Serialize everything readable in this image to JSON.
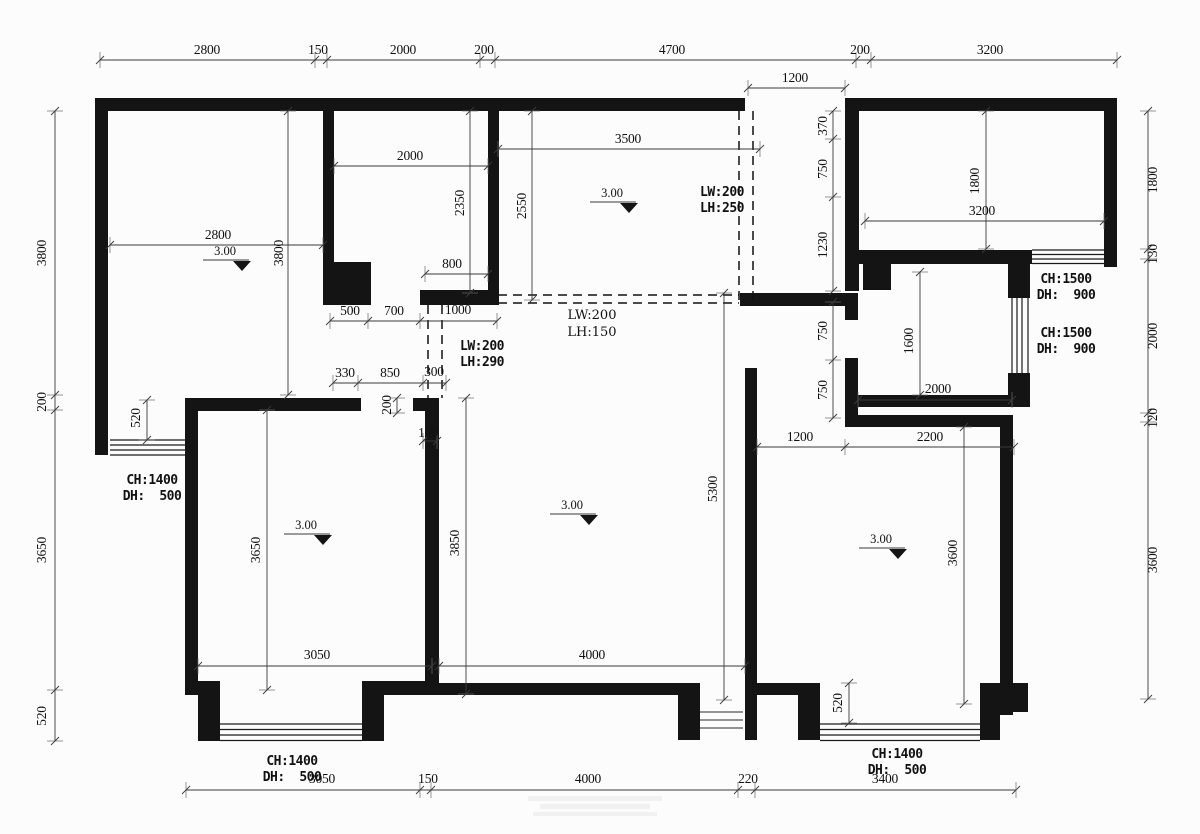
{
  "style": {
    "background": "#fcfcfc",
    "wall_color": "#141414",
    "dim_color": "#3a3a3a"
  },
  "labels": [
    {
      "text": "2800",
      "x": 207,
      "y": 54
    },
    {
      "text": "150",
      "x": 318,
      "y": 54
    },
    {
      "text": "2000",
      "x": 403,
      "y": 54
    },
    {
      "text": "200",
      "x": 484,
      "y": 54
    },
    {
      "text": "4700",
      "x": 672,
      "y": 54
    },
    {
      "text": "200",
      "x": 860,
      "y": 54
    },
    {
      "text": "3200",
      "x": 990,
      "y": 54
    },
    {
      "text": "1200",
      "x": 795,
      "y": 82
    },
    {
      "text": "3800",
      "x": 46,
      "y": 253,
      "rot": 1
    },
    {
      "text": "200",
      "x": 46,
      "y": 402,
      "rot": 1
    },
    {
      "text": "3650",
      "x": 46,
      "y": 550,
      "rot": 1
    },
    {
      "text": "520",
      "x": 46,
      "y": 716,
      "rot": 1
    },
    {
      "text": "1800",
      "x": 1157,
      "y": 180,
      "rot": 1
    },
    {
      "text": "130",
      "x": 1157,
      "y": 254,
      "rot": 1
    },
    {
      "text": "2000",
      "x": 1157,
      "y": 336,
      "rot": 1
    },
    {
      "text": "120",
      "x": 1157,
      "y": 418,
      "rot": 1
    },
    {
      "text": "3600",
      "x": 1157,
      "y": 560,
      "rot": 1
    },
    {
      "text": "3050",
      "x": 322,
      "y": 783
    },
    {
      "text": "150",
      "x": 428,
      "y": 783
    },
    {
      "text": "4000",
      "x": 588,
      "y": 783
    },
    {
      "text": "220",
      "x": 748,
      "y": 783
    },
    {
      "text": "3400",
      "x": 885,
      "y": 783
    },
    {
      "text": "2800",
      "x": 218,
      "y": 239
    },
    {
      "text": "3800",
      "x": 283,
      "y": 253,
      "rot": 1
    },
    {
      "text": "520",
      "x": 140,
      "y": 418,
      "rot": 1
    },
    {
      "text": "2000",
      "x": 410,
      "y": 160
    },
    {
      "text": "2350",
      "x": 464,
      "y": 203,
      "rot": 1
    },
    {
      "text": "800",
      "x": 452,
      "y": 268
    },
    {
      "text": "500",
      "x": 350,
      "y": 315
    },
    {
      "text": "700",
      "x": 394,
      "y": 315
    },
    {
      "text": "1000",
      "x": 458,
      "y": 314
    },
    {
      "text": "330",
      "x": 345,
      "y": 377
    },
    {
      "text": "850",
      "x": 390,
      "y": 377
    },
    {
      "text": "300",
      "x": 434,
      "y": 376
    },
    {
      "text": "200",
      "x": 391,
      "y": 405,
      "rot": 1
    },
    {
      "text": "100",
      "x": 428,
      "y": 437
    },
    {
      "text": "3500",
      "x": 628,
      "y": 143
    },
    {
      "text": "2550",
      "x": 526,
      "y": 206,
      "rot": 1
    },
    {
      "text": "370",
      "x": 827,
      "y": 126,
      "rot": 1
    },
    {
      "text": "750",
      "x": 827,
      "y": 169,
      "rot": 1
    },
    {
      "text": "1230",
      "x": 827,
      "y": 245,
      "rot": 1
    },
    {
      "text": "750",
      "x": 827,
      "y": 331,
      "rot": 1
    },
    {
      "text": "750",
      "x": 827,
      "y": 390,
      "rot": 1
    },
    {
      "text": "1800",
      "x": 979,
      "y": 181,
      "rot": 1
    },
    {
      "text": "3200",
      "x": 982,
      "y": 215
    },
    {
      "text": "1600",
      "x": 913,
      "y": 341,
      "rot": 1
    },
    {
      "text": "2000",
      "x": 938,
      "y": 393
    },
    {
      "text": "1200",
      "x": 800,
      "y": 441
    },
    {
      "text": "2200",
      "x": 930,
      "y": 441
    },
    {
      "text": "3850",
      "x": 459,
      "y": 543,
      "rot": 1
    },
    {
      "text": "5300",
      "x": 717,
      "y": 489,
      "rot": 1
    },
    {
      "text": "4000",
      "x": 592,
      "y": 659
    },
    {
      "text": "3650",
      "x": 260,
      "y": 550,
      "rot": 1
    },
    {
      "text": "3050",
      "x": 317,
      "y": 659
    },
    {
      "text": "3600",
      "x": 957,
      "y": 553,
      "rot": 1
    },
    {
      "text": "520",
      "x": 842,
      "y": 703,
      "rot": 1
    },
    {
      "text": "LW:200",
      "x": 722,
      "y": 196,
      "cls": "b"
    },
    {
      "text": "LH:250",
      "x": 722,
      "y": 212,
      "cls": "b"
    },
    {
      "text": "LW:200",
      "x": 592,
      "y": 319,
      "cls": "n"
    },
    {
      "text": "LH:150",
      "x": 592,
      "y": 336,
      "cls": "n"
    },
    {
      "text": "LW:200",
      "x": 482,
      "y": 350,
      "cls": "b"
    },
    {
      "text": "LH:290",
      "x": 482,
      "y": 366,
      "cls": "b"
    },
    {
      "text": "CH:1500",
      "x": 1066,
      "y": 283,
      "cls": "b"
    },
    {
      "text": "DH:  900",
      "x": 1066,
      "y": 299,
      "cls": "b"
    },
    {
      "text": "CH:1500",
      "x": 1066,
      "y": 337,
      "cls": "b"
    },
    {
      "text": "DH:  900",
      "x": 1066,
      "y": 353,
      "cls": "b"
    },
    {
      "text": "CH:1400",
      "x": 152,
      "y": 484,
      "cls": "b"
    },
    {
      "text": "DH:  500",
      "x": 152,
      "y": 500,
      "cls": "b"
    },
    {
      "text": "CH:1400",
      "x": 292,
      "y": 765,
      "cls": "b"
    },
    {
      "text": "DH:  500",
      "x": 292,
      "y": 781,
      "cls": "b"
    },
    {
      "text": "CH:1400",
      "x": 897,
      "y": 758,
      "cls": "b"
    },
    {
      "text": "DH:  500",
      "x": 897,
      "y": 774,
      "cls": "b"
    }
  ],
  "level_markers": [
    {
      "label": "3.00",
      "x": 225,
      "y": 255
    },
    {
      "label": "3.00",
      "x": 612,
      "y": 197
    },
    {
      "label": "3.00",
      "x": 572,
      "y": 509
    },
    {
      "label": "3.00",
      "x": 306,
      "y": 529
    },
    {
      "label": "3.00",
      "x": 881,
      "y": 543
    }
  ]
}
